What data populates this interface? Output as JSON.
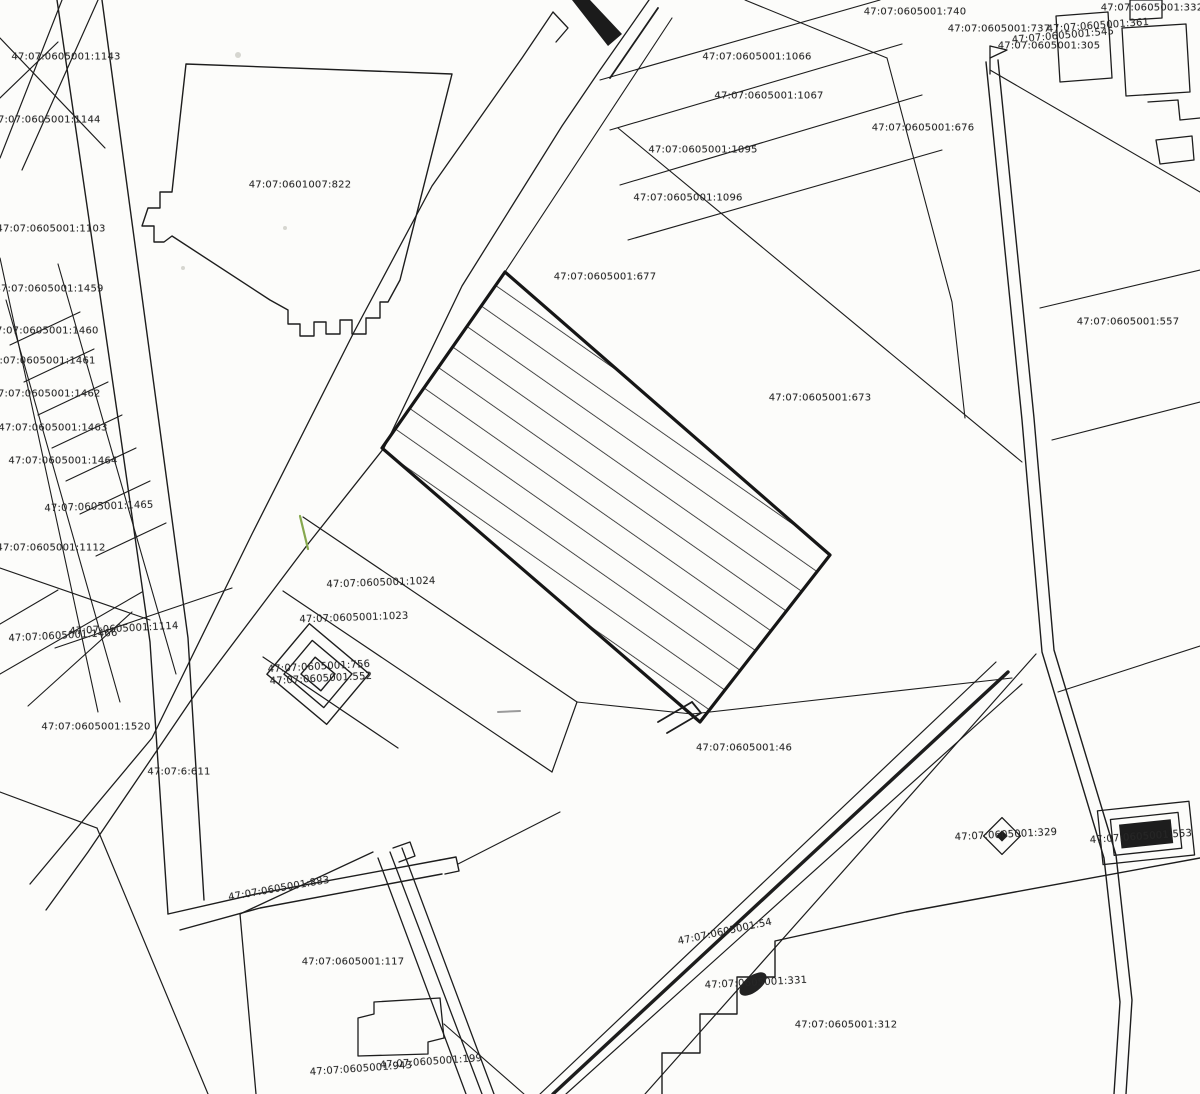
{
  "map": {
    "type": "cadastral-parcel-plan",
    "colors": {
      "line": "#1d1d1d",
      "paper": "#fcfcfa",
      "label_text": "#262626",
      "highlight_green": "#86a84e"
    },
    "labels": [
      {
        "text": "47:07:0605001:740",
        "x": 915,
        "y": 12,
        "rot": 0
      },
      {
        "text": "47:07:0605001:1066",
        "x": 757,
        "y": 57,
        "rot": 0
      },
      {
        "text": "47:07:0605001:737",
        "x": 999,
        "y": 29,
        "rot": 0
      },
      {
        "text": "47:07:0605001:361",
        "x": 1098,
        "y": 26,
        "rot": -4
      },
      {
        "text": "47:07:0605001:545",
        "x": 1063,
        "y": 36,
        "rot": -5
      },
      {
        "text": "47:07:0605001:305",
        "x": 1049,
        "y": 46,
        "rot": 0
      },
      {
        "text": "47:07:0605001:332",
        "x": 1152,
        "y": 8,
        "rot": 0
      },
      {
        "text": "47:07:0605001:1067",
        "x": 769,
        "y": 96,
        "rot": 0
      },
      {
        "text": "47:07:0605001:676",
        "x": 923,
        "y": 128,
        "rot": 0
      },
      {
        "text": "47:07:0605001:1095",
        "x": 703,
        "y": 150,
        "rot": 0
      },
      {
        "text": "47:07:0605001:1096",
        "x": 688,
        "y": 198,
        "rot": 0
      },
      {
        "text": "47:07:0601007:822",
        "x": 300,
        "y": 185,
        "rot": 0
      },
      {
        "text": "47:07:0605001:1143",
        "x": 66,
        "y": 57,
        "rot": 0
      },
      {
        "text": "47:07:0605001:1144",
        "x": 46,
        "y": 120,
        "rot": 0
      },
      {
        "text": "47:07:0605001:1103",
        "x": 51,
        "y": 229,
        "rot": 0
      },
      {
        "text": "47:07:0605001:677",
        "x": 605,
        "y": 277,
        "rot": 0
      },
      {
        "text": "47:07:0605001:1459",
        "x": 49,
        "y": 289,
        "rot": 0
      },
      {
        "text": "47:07:0605001:557",
        "x": 1128,
        "y": 322,
        "rot": 0
      },
      {
        "text": "47:07:0605001:1460",
        "x": 44,
        "y": 331,
        "rot": 0
      },
      {
        "text": "47:07:0605001:1461",
        "x": 41,
        "y": 361,
        "rot": 0
      },
      {
        "text": "47:07:0605001:1462",
        "x": 46,
        "y": 394,
        "rot": 0
      },
      {
        "text": "47:07:0605001:1463",
        "x": 53,
        "y": 428,
        "rot": 0
      },
      {
        "text": "47:07:0605001:1464",
        "x": 63,
        "y": 461,
        "rot": 0
      },
      {
        "text": "47:07:0605001:673",
        "x": 820,
        "y": 398,
        "rot": 0
      },
      {
        "text": "47:07:0605001:1465",
        "x": 99,
        "y": 507,
        "rot": -2
      },
      {
        "text": "47:07:0605001:1112",
        "x": 51,
        "y": 548,
        "rot": 0
      },
      {
        "text": "47:07:0605001:1024",
        "x": 381,
        "y": 583,
        "rot": -2
      },
      {
        "text": "47:07:0605001:1023",
        "x": 354,
        "y": 618,
        "rot": -2
      },
      {
        "text": "47:07:0605001:1114",
        "x": 124,
        "y": 629,
        "rot": -3
      },
      {
        "text": "47:07:0605001:1466",
        "x": 63,
        "y": 636,
        "rot": -3
      },
      {
        "text": "47:07:0605001:756",
        "x": 319,
        "y": 667,
        "rot": -3
      },
      {
        "text": "47:07:0605001:552",
        "x": 321,
        "y": 679,
        "rot": -3
      },
      {
        "text": "47:07:0605001:1520",
        "x": 96,
        "y": 727,
        "rot": 0
      },
      {
        "text": "47:07:0605001:46",
        "x": 744,
        "y": 748,
        "rot": 0
      },
      {
        "text": "47:07:6:611",
        "x": 179,
        "y": 772,
        "rot": 0
      },
      {
        "text": "47:07:0605001:329",
        "x": 1006,
        "y": 835,
        "rot": -3
      },
      {
        "text": "47:07:0605001:553",
        "x": 1141,
        "y": 837,
        "rot": -4
      },
      {
        "text": "47:07:0605001:883",
        "x": 279,
        "y": 889,
        "rot": -10
      },
      {
        "text": "47:07:0605001:54",
        "x": 725,
        "y": 932,
        "rot": -12
      },
      {
        "text": "47:07:0605001:117",
        "x": 353,
        "y": 962,
        "rot": 0
      },
      {
        "text": "47:07:0605001:331",
        "x": 756,
        "y": 983,
        "rot": -3
      },
      {
        "text": "47:07:0605001:312",
        "x": 846,
        "y": 1025,
        "rot": 0
      },
      {
        "text": "47:07:0605001:199",
        "x": 431,
        "y": 1062,
        "rot": -4
      },
      {
        "text": "47:07:0605001:943",
        "x": 361,
        "y": 1069,
        "rot": -4
      }
    ],
    "symbols": [
      {
        "name": "hatched-parcel",
        "desc": "thick-bordered parcel filled with diagonal hatch stripes"
      },
      {
        "name": "nested-diamonds-marker",
        "desc": "three concentric rotated squares near parcels 756/552"
      },
      {
        "name": "diamond-marker",
        "desc": "small diamond with dark center at parcel 329"
      },
      {
        "name": "building-marker",
        "desc": "nested rectangles with solid dark core at parcel 553"
      },
      {
        "name": "flag-marker",
        "desc": "small flag on pole at top of right street"
      },
      {
        "name": "dark-blob-marker",
        "desc": "dark filled blob at parcel 331"
      }
    ]
  }
}
